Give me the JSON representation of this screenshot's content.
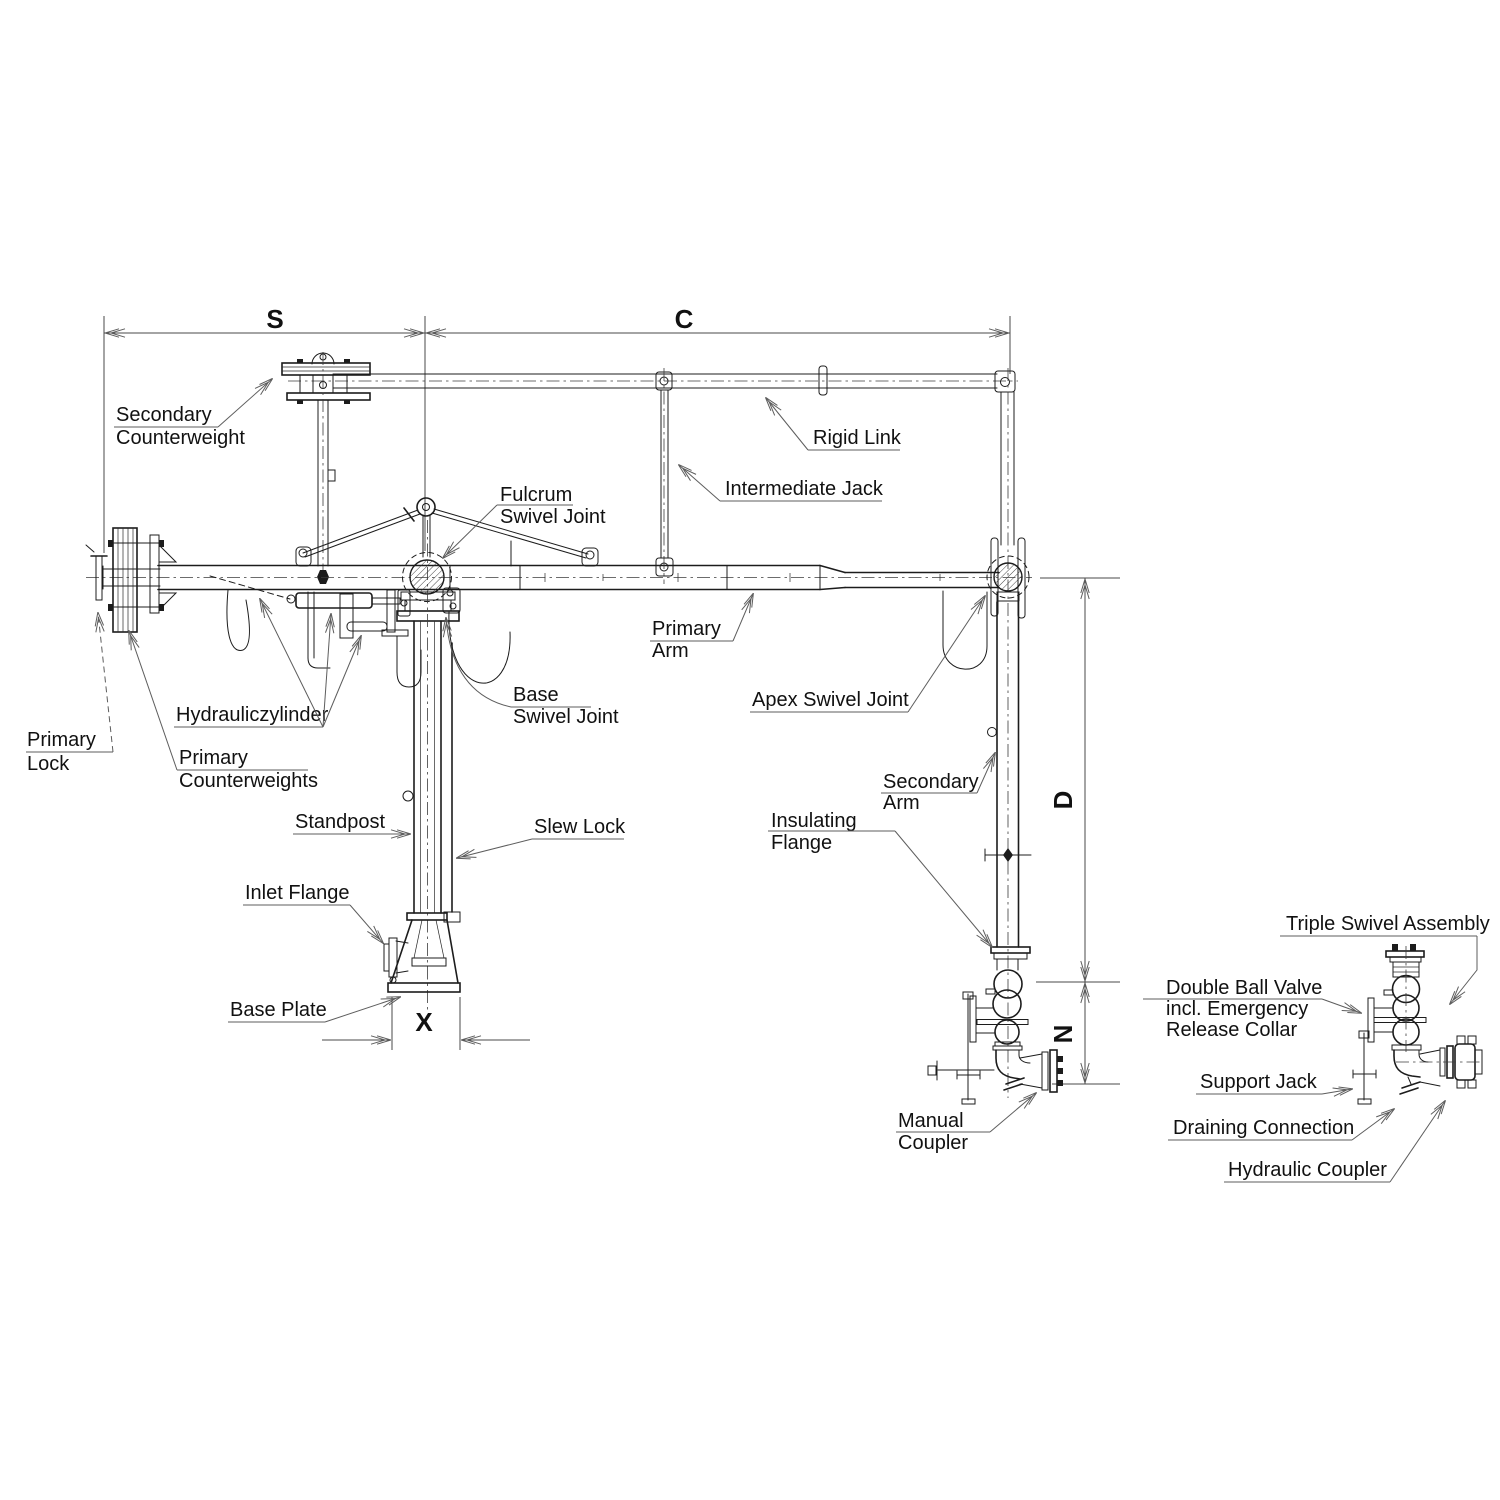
{
  "colors": {
    "background": "#ffffff",
    "line": "#1c1c1c",
    "leader": "#5d5d5d"
  },
  "dimensions": {
    "s": "S",
    "c": "C",
    "x": "X",
    "d": "D",
    "n": "N"
  },
  "labels": {
    "secondary_counterweight": [
      "Secondary",
      "Counterweight"
    ],
    "rigid_link": [
      "Rigid Link"
    ],
    "intermediate_jack": [
      "Intermediate Jack"
    ],
    "fulcrum_swivel_joint": [
      "Fulcrum",
      "Swivel Joint"
    ],
    "primary_arm": [
      "Primary",
      "Arm"
    ],
    "apex_swivel_joint": [
      "Apex Swivel Joint"
    ],
    "base_swivel_joint": [
      "Base",
      "Swivel Joint"
    ],
    "hydraulic_cylinder": [
      "Hydrauliczylinder"
    ],
    "primary_lock": [
      "Primary",
      "Lock"
    ],
    "primary_counterweights": [
      "Primary",
      "Counterweights"
    ],
    "standpost": [
      "Standpost"
    ],
    "slew_lock": [
      "Slew Lock"
    ],
    "inlet_flange": [
      "Inlet Flange"
    ],
    "base_plate": [
      "Base Plate"
    ],
    "secondary_arm": [
      "Secondary",
      "Arm"
    ],
    "insulating_flange": [
      "Insulating",
      "Flange"
    ],
    "manual_coupler": [
      "Manual",
      "Coupler"
    ],
    "triple_swivel_assembly": [
      "Triple Swivel Assembly"
    ],
    "double_ball_valve": [
      "Double Ball Valve",
      "incl. Emergency",
      "Release Collar"
    ],
    "support_jack": [
      "Support Jack"
    ],
    "draining_connection": [
      "Draining Connection"
    ],
    "hydraulic_coupler": [
      "Hydraulic Coupler"
    ]
  }
}
